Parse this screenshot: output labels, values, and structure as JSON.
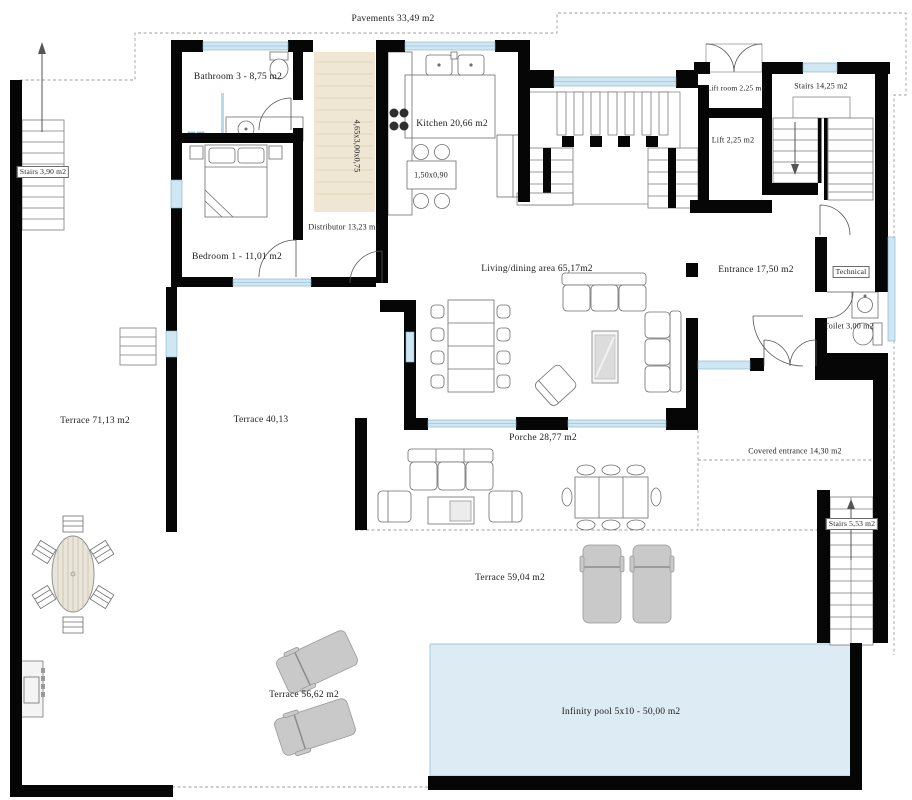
{
  "title": "Villa ground floor plan",
  "colors": {
    "wall": "#060606",
    "window": "#cfe7f3",
    "pool": "#dcebf4",
    "wood_floor": "#efe6d4",
    "lounger": "#c9c9c9",
    "boundary_dash": "#9f9f9f",
    "text": "#1c1c1c"
  },
  "rooms": {
    "pavements": {
      "label": "Pavements 33,49 m2"
    },
    "bathroom3": {
      "label": "Bathroom 3 - 8,75 m2"
    },
    "corridor_dim": {
      "label": "4,65x3,00x0,75"
    },
    "kitchen": {
      "label": "Kitchen 20,66 m2"
    },
    "kitchen_table_dim": {
      "label": "1,50x0,90"
    },
    "lift_room": {
      "label": "Lift room 2,25 m2"
    },
    "stairs_top_right": {
      "label": "Stairs 14,25 m2"
    },
    "lift": {
      "label": "Lift 2,25 m2"
    },
    "stairs_left": {
      "label": "Stairs 3,90 m2"
    },
    "distributor": {
      "label": "Distributor 13,23 m2"
    },
    "bedroom1": {
      "label": "Bedroom 1 - 11,01 m2"
    },
    "living_dining": {
      "label": "Living/dining area  65,17m2"
    },
    "entrance": {
      "label": "Entrance 17,50 m2"
    },
    "technical": {
      "label": "Technical"
    },
    "toilet": {
      "label": "Toilet 3,00 m2"
    },
    "terrace_left": {
      "label": "Terrace  71,13 m2"
    },
    "terrace_mid": {
      "label": "Terrace  40,13"
    },
    "porche": {
      "label": "Porche  28,77 m2"
    },
    "covered_entrance": {
      "label": "Covered entrance 14,30 m2"
    },
    "stairs_bottom_right": {
      "label": "Stairs 5,53 m2"
    },
    "terrace_back": {
      "label": "Terrace  59,04 m2"
    },
    "terrace_pool": {
      "label": "Terrace  56,62 m2"
    },
    "pool": {
      "label": "Infinity pool 5x10 - 50,00 m2"
    }
  }
}
